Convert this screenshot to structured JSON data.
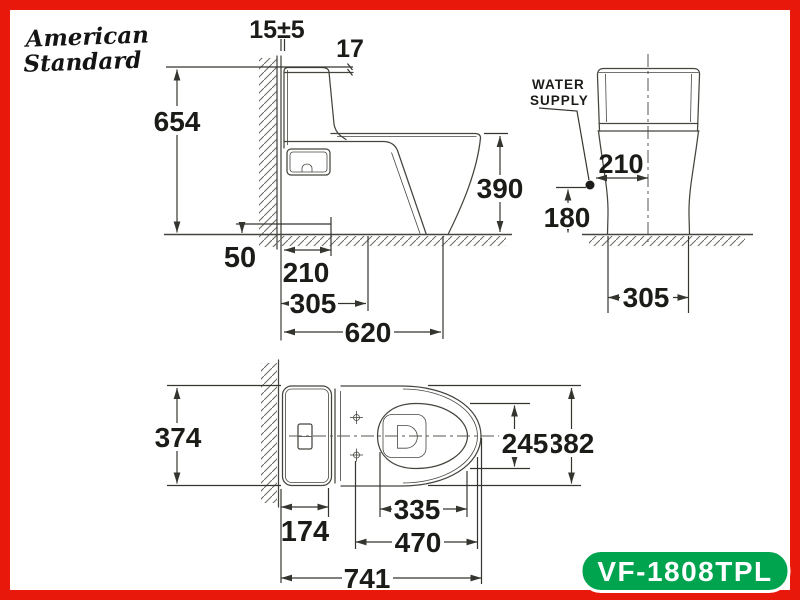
{
  "logo": {
    "line1": "American",
    "line2": "Standard"
  },
  "side_view": {
    "wall_gap": "15±5",
    "lid_thickness": "17",
    "overall_height": "654",
    "rim_height": "390",
    "supply_height_ref": "50",
    "supply_depth": "210",
    "rough_in": "305",
    "bowl_depth": "620"
  },
  "rear_view": {
    "water_supply_line1": "WATER",
    "water_supply_line2": "SUPPLY",
    "supply_offset": "210",
    "supply_height": "180",
    "base_width": "305"
  },
  "plan_view": {
    "tank_width": "374",
    "bowl_inner_width": "245",
    "seat_width": "382",
    "tank_depth": "174",
    "bowl_opening_length": "335",
    "seat_length": "470",
    "overall_length": "741"
  },
  "badge": {
    "model": "VF-1808TPL"
  },
  "colors": {
    "border_red": "#e8190b",
    "badge_green": "#00a44f",
    "line_gray": "#45453f",
    "text_black": "#1b1b18"
  }
}
